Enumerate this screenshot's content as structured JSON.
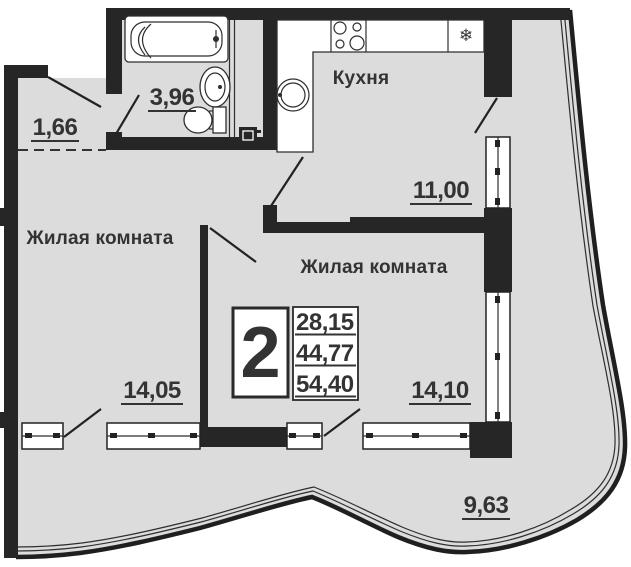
{
  "plan": {
    "title": "2-room apartment floor plan",
    "info_box": {
      "rooms_count": "2",
      "area_living": "28,15",
      "area_main": "44,77",
      "area_total": "54,40"
    },
    "rooms": {
      "hall": {
        "area": "1,66"
      },
      "bathroom": {
        "area": "3,96"
      },
      "kitchen": {
        "name": "Кухня",
        "area": "11,00"
      },
      "living1": {
        "name": "Жилая комната",
        "area": "14,05"
      },
      "living2": {
        "name": "Жилая комната",
        "area": "14,10"
      },
      "balcony": {
        "area": "9,63"
      }
    },
    "icons": {
      "fridge_snowflake": "❄"
    },
    "colors": {
      "wall": "#262626",
      "floor": "#dcdcdc",
      "line": "#1f1f1f",
      "text": "#333333"
    }
  }
}
